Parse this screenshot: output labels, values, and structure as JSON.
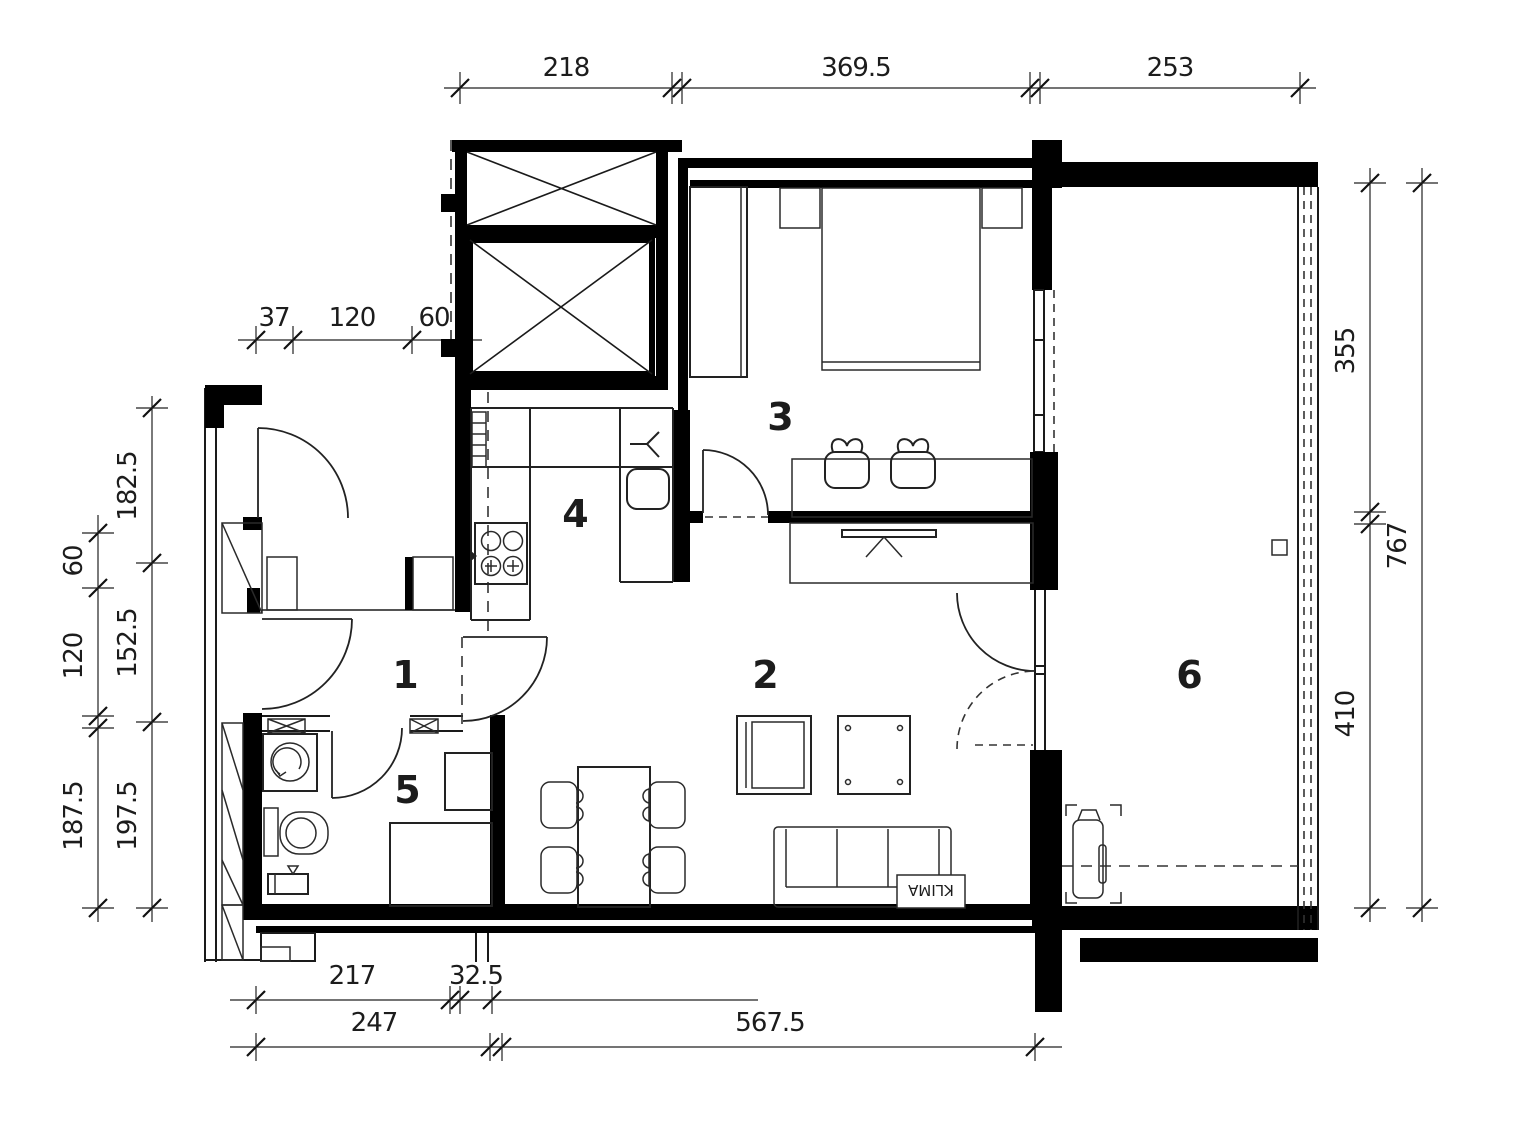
{
  "plan": {
    "rooms": {
      "r1": "1",
      "r2": "2",
      "r3": "3",
      "r4": "4",
      "r5": "5",
      "r6": "6"
    },
    "dims": {
      "top": [
        "218",
        "369.5",
        "253"
      ],
      "entrance": [
        "37",
        "120",
        "60"
      ],
      "left_outer": [
        "182.5",
        "152.5",
        "197.5"
      ],
      "left_inner": [
        "60",
        "120",
        "187.5"
      ],
      "right_inner": [
        "355",
        "410"
      ],
      "right_outer": [
        "767"
      ],
      "bottom_upper": [
        "217",
        "32.5"
      ],
      "bottom_lower": [
        "247",
        "567.5"
      ]
    },
    "labels": {
      "klima": "KLIMA"
    }
  }
}
